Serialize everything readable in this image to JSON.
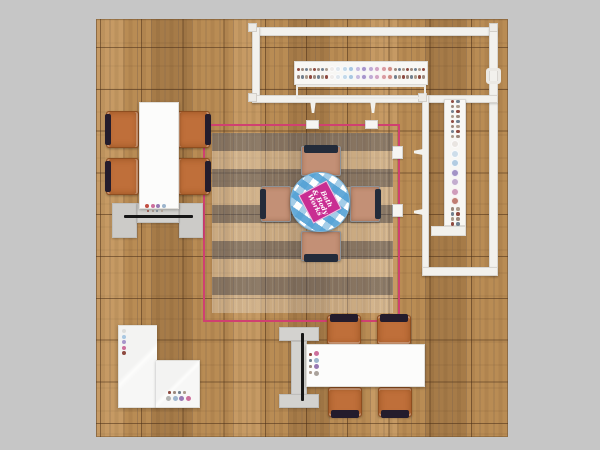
{
  "scene": {
    "description": "Top-down plan render of a Bath & Body Works trade show exhibit booth on wood plank flooring",
    "logo": {
      "full_text": "Bath & Body Works",
      "lines": [
        "Bath",
        "& Body",
        "Works"
      ]
    }
  },
  "palette": {
    "canvas-bg": "#c6c6c6",
    "wood-base": "#b98c54",
    "grid-line": "rgba(74,46,22,0.55)",
    "wall": "#f2f1ed",
    "wall-edge": "#d8d5d0",
    "pink-truss": "#d04071",
    "logo-pink": "#c92d92",
    "cloth-blue": "#4f9fd4",
    "chair-orange": "#bf6f3a",
    "chair-back": "#241c2c",
    "seat-tan": "#c39076",
    "seat-back": "#232b3a",
    "unit-gray": "#d3d2cf",
    "tv": "#161616",
    "white-furn": "#fcfcfb"
  },
  "dots": {
    "small_cycle": [
      "#8e4a40",
      "#9b887c",
      "#71808f",
      "#ab9a8b"
    ],
    "horizontal_large": [
      "#efecea",
      "#dfe7ee",
      "#c3d9ea",
      "#a9c7e1",
      "#c7bade",
      "#a795cb",
      "#bfaad4",
      "#d2a3c3",
      "#d99ba0",
      "#cf8e85"
    ],
    "vertical_large": [
      "#e9e5e1",
      "#cdddea",
      "#b2cce2",
      "#a293c6",
      "#c3adcf",
      "#cf9cba",
      "#c07d72"
    ],
    "left_table_row": [
      "#c24f43",
      "#cd6f9c",
      "#9879b4",
      "#9db5cd"
    ],
    "left_table_tiny": [
      "#8e4a40",
      "#9b887c",
      "#71808f",
      "#ab9a8b"
    ],
    "bottom_table_large": [
      "#cd6f9c",
      "#9db5cd",
      "#9879b4",
      "#aaa29b"
    ],
    "bottom_table_small": [
      "#8e4a40",
      "#71808f",
      "#9b887c",
      "#ab9a8b"
    ],
    "desk_column": [
      "#dddddb",
      "#a9c7e1",
      "#a795cb",
      "#cd6f9c",
      "#8e4a40"
    ],
    "desk_row_small": [
      "#8e4a40",
      "#9b887c",
      "#71808f",
      "#ab9a8b"
    ],
    "desk_row_large": [
      "#b3b3b1",
      "#9db5cd",
      "#9879b4",
      "#cd6f9c"
    ]
  },
  "strip_layout": {
    "horizontal_rows": 2,
    "horizontal_small_per_side": 8,
    "vertical_top_small_rows": 8,
    "vertical_bottom_small_rows": 4
  }
}
